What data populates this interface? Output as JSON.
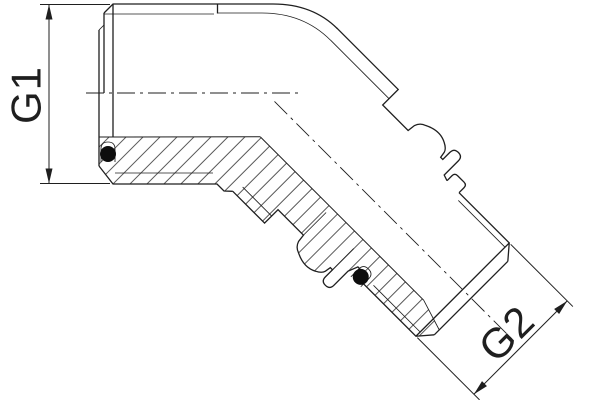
{
  "drawing": {
    "dimension_labels": {
      "g1": "G1",
      "g2": "G2"
    }
  },
  "colors": {
    "line": "#1f1f1f",
    "background": "#ffffff",
    "seal": "#0d0d0d"
  }
}
